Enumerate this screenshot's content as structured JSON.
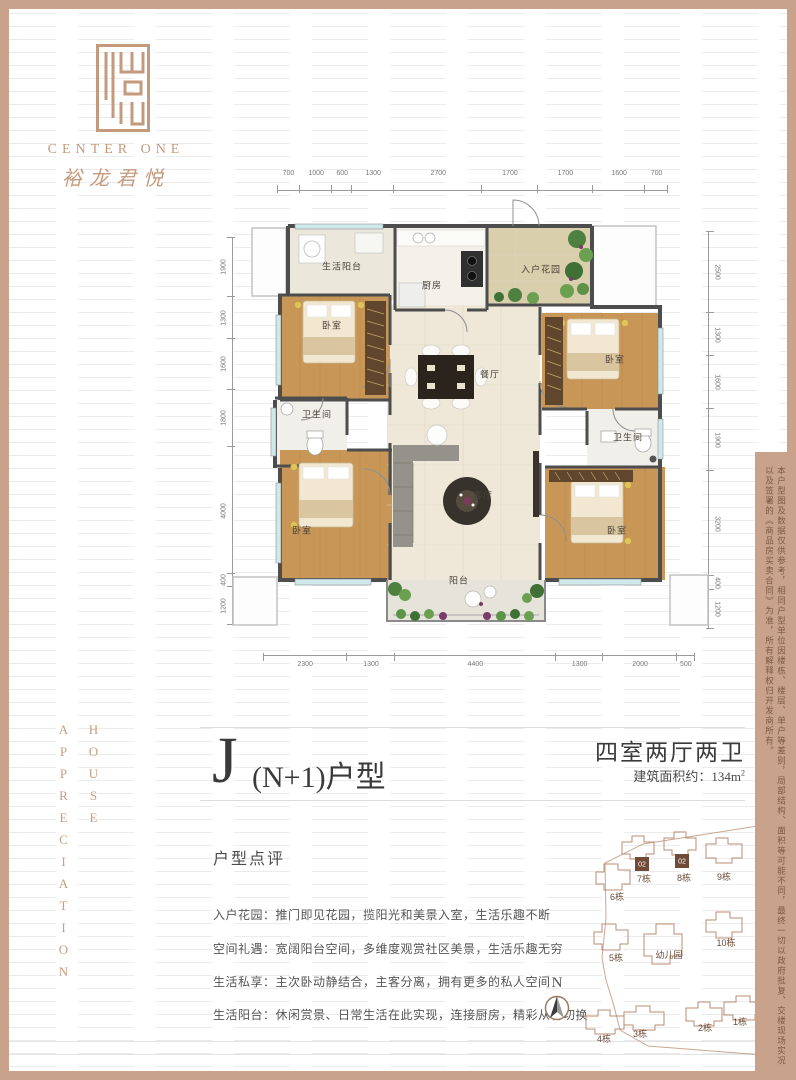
{
  "brand": {
    "logo_en": "CENTER ONE",
    "logo_cn": "裕龙君悦",
    "accent_color": "#c49a7e"
  },
  "side_words": {
    "word1": "HOUSE",
    "word2": "APPRECIATION"
  },
  "floorplan": {
    "dims_top": [
      "700",
      "1000",
      "600",
      "1300",
      "2700",
      "1700",
      "1700",
      "1600",
      "700"
    ],
    "dims_bottom": [
      "2300",
      "1300",
      "4400",
      "1300",
      "2000",
      "500"
    ],
    "dims_left": [
      "1900",
      "1300",
      "1600",
      "1800",
      "4000",
      "400",
      "1200"
    ],
    "dims_right": [
      "2500",
      "1300",
      "1600",
      "1900",
      "3200",
      "400",
      "1200"
    ],
    "rooms": {
      "life_balcony": "生活阳台",
      "kitchen": "厨房",
      "entry_garden": "入户花园",
      "bedroom": "卧室",
      "bathroom": "卫生间",
      "dining": "餐厅",
      "living": "客厅",
      "balcony": "阳台"
    }
  },
  "title": {
    "big_letter": "J",
    "suffix": "(N+1)户型",
    "spec": "四室两厅两卫",
    "area_label": "建筑面积约：",
    "area_value": "134m",
    "area_sup": "2"
  },
  "review": {
    "heading": "户型点评",
    "items": [
      "入户花园：推门即见花园，揽阳光和美景入室，生活乐趣不断",
      "空间礼遇：宽阔阳台空间，多维度观赏社区美景，生活乐趣无穷",
      "生活私享：主次卧动静结合，主客分离，拥有更多的私人空间",
      "生活阳台：休闲赏景、日常生活在此实现，连接厨房，精彩从容切换"
    ]
  },
  "siteplan": {
    "highlight_label": "02",
    "highlight_color": "#6f4b38",
    "outline_color": "#b98e76",
    "kindergarten": "幼儿园",
    "north_label": "N",
    "buildings": [
      {
        "label": "7栋"
      },
      {
        "label": "8栋"
      },
      {
        "label": "9栋"
      },
      {
        "label": "6栋"
      },
      {
        "label": "10栋"
      },
      {
        "label": "5栋"
      },
      {
        "label": "4栋"
      },
      {
        "label": "3栋"
      },
      {
        "label": "2栋"
      },
      {
        "label": "1栋"
      }
    ]
  },
  "disclaimer": "本户型图及数据仅供参考，相同户型单位因楼栋、楼层、单户等差别，局部结构、面积等可能不同，最终一切以政府批复、交楼现场实况以及签署的《商品房买卖合同》为准，所有解释权归开发商所有。"
}
